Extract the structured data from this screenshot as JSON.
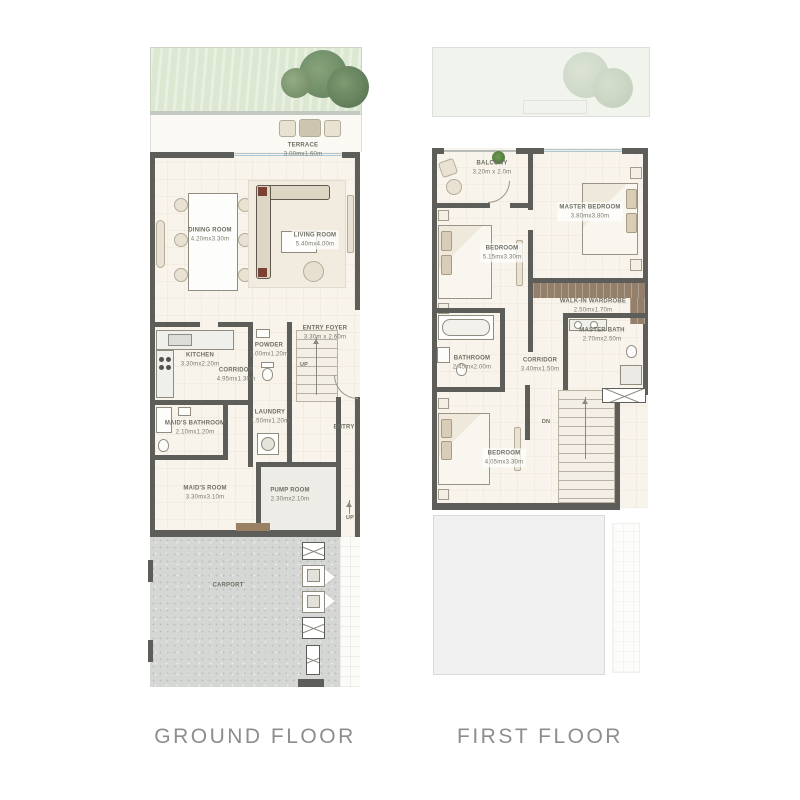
{
  "page": {
    "type": "floor-plan-sheet",
    "background": "#ffffff"
  },
  "colors": {
    "wall": "#5d5d59",
    "floor": "#f8f4ec",
    "garden": "#dce8d2",
    "tree": "#6f8c68",
    "carport": "#d4d7d4",
    "ghost": "#f0f1f0",
    "window": "#aec4cf",
    "label_text": "#6e6e62",
    "caption_text": "#8d8d8d"
  },
  "ground_floor": {
    "title": "GROUND FLOOR",
    "rooms": [
      {
        "name": "TERRACE",
        "dims": "3.00mx1.60m"
      },
      {
        "name": "DINING ROOM",
        "dims": "4.20mx3.30m"
      },
      {
        "name": "LIVING ROOM",
        "dims": "5.40mx4.00m"
      },
      {
        "name": "KITCHEN",
        "dims": "3.30mx2.20m"
      },
      {
        "name": "CORRIDOR",
        "dims": "4.95mx1.30m"
      },
      {
        "name": "POWDER",
        "dims": "2.00mx1.20m"
      },
      {
        "name": "ENTRY FOYER",
        "dims": "3.30m x 2.60m"
      },
      {
        "name": "LAUNDRY",
        "dims": "1.50mx1.20m"
      },
      {
        "name": "MAID'S BATHROOM",
        "dims": "2.10mx1.20m"
      },
      {
        "name": "MAID'S ROOM",
        "dims": "3.30mx3.10m"
      },
      {
        "name": "PUMP ROOM",
        "dims": "2.30mx2.10m"
      },
      {
        "name": "CARPORT",
        "dims": ""
      },
      {
        "name": "ENTRY",
        "dims": ""
      }
    ],
    "stair_label": "UP",
    "walkway_label": "UP"
  },
  "first_floor": {
    "title": "FIRST FLOOR",
    "rooms": [
      {
        "name": "BALCONY",
        "dims": "3.20m x 2.0m"
      },
      {
        "name": "MASTER BEDROOM",
        "dims": "3.80mx3.80m"
      },
      {
        "name": "BEDROOM",
        "dims": "5.15mx3.30m"
      },
      {
        "name": "WALK-IN WARDROBE",
        "dims": "2.50mx1.70m"
      },
      {
        "name": "MASTER BATH",
        "dims": "2.70mx2.50m"
      },
      {
        "name": "BATHROOM",
        "dims": "2.45mx2.00m"
      },
      {
        "name": "CORRIDOR",
        "dims": "3.40mx1.50m"
      },
      {
        "name": "BEDROOM",
        "dims": "4.05mx3.30m"
      }
    ],
    "stair_label": "DN"
  }
}
